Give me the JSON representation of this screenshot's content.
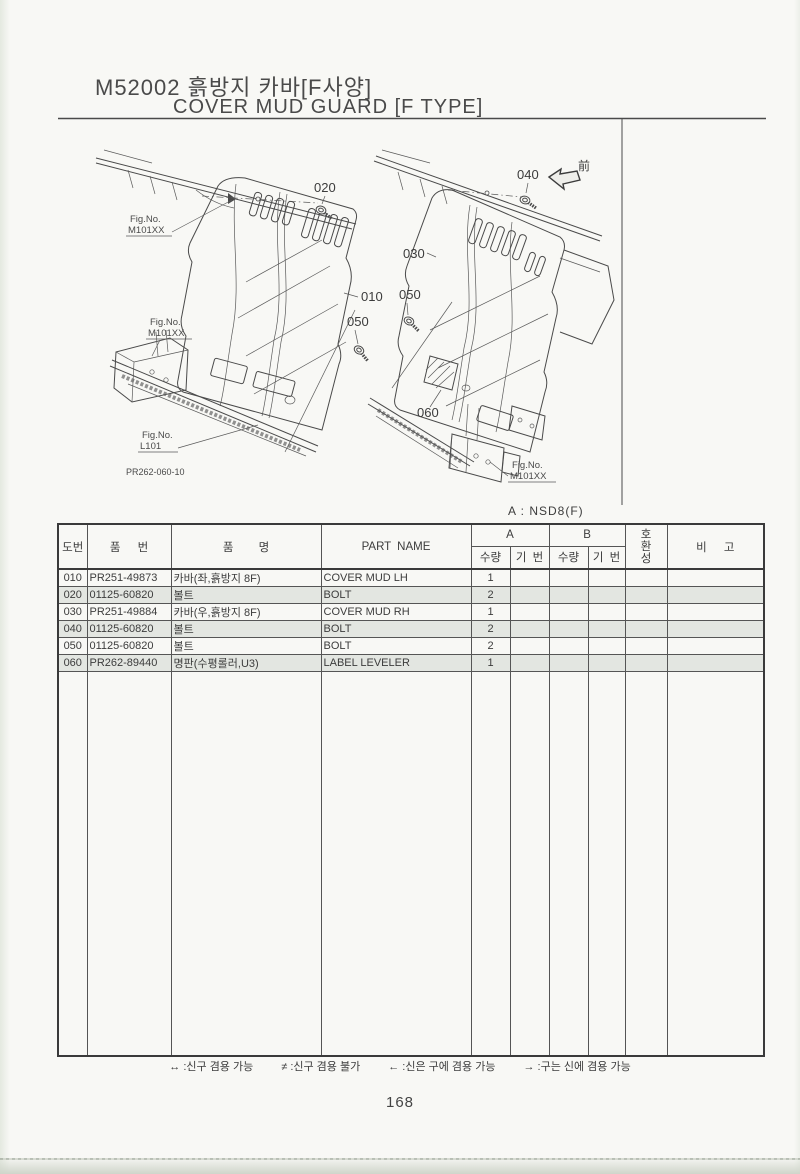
{
  "page": {
    "title_line1": "M52002 흙방지 카바[F사양]",
    "title_line2": "COVER MUD GUARD [F TYPE]",
    "variant_note": "A : NSD8(F)",
    "page_number": "168"
  },
  "diagram": {
    "callouts": {
      "c010": "010",
      "c020": "020",
      "c030": "030",
      "c040": "040",
      "c050": "050",
      "c060": "060"
    },
    "fig_no_label": "Fig.No.",
    "fig_m101xx": "M101XX",
    "fig_l101": "L101",
    "drawing_ref": "PR262-060-10",
    "front_marker": "前"
  },
  "table": {
    "headers": {
      "fig_no": "도번",
      "part_no": "품 번",
      "name_kr": "품 명",
      "part_name": "PART NAME",
      "group_a": "A",
      "group_b": "B",
      "qty": "수량",
      "serial": "기 번",
      "compat_chars": [
        "호",
        "환",
        "성"
      ],
      "remarks": "비 고"
    },
    "rows": [
      {
        "no": "010",
        "part_no": "PR251-49873",
        "name_kr": "카바(좌,흙방지 8F)",
        "part_name": "COVER MUD LH",
        "qty_a": "1"
      },
      {
        "no": "020",
        "part_no": "01125-60820",
        "name_kr": "볼트",
        "part_name": "BOLT",
        "qty_a": "2"
      },
      {
        "no": "030",
        "part_no": "PR251-49884",
        "name_kr": "카바(우,흙방지 8F)",
        "part_name": "COVER MUD RH",
        "qty_a": "1"
      },
      {
        "no": "040",
        "part_no": "01125-60820",
        "name_kr": "볼트",
        "part_name": "BOLT",
        "qty_a": "2"
      },
      {
        "no": "050",
        "part_no": "01125-60820",
        "name_kr": "볼트",
        "part_name": "BOLT",
        "qty_a": "2"
      },
      {
        "no": "060",
        "part_no": "PR262-89440",
        "name_kr": "명판(수평롤러,U3)",
        "part_name": "LABEL LEVELER",
        "qty_a": "1"
      }
    ]
  },
  "footer": {
    "legend": [
      "↔ :신구 겸용 가능",
      "≠ :신구 겸용 불가",
      "← :신은 구에 겸용 가능",
      "→ :구는 신에 겸용 가능"
    ]
  }
}
